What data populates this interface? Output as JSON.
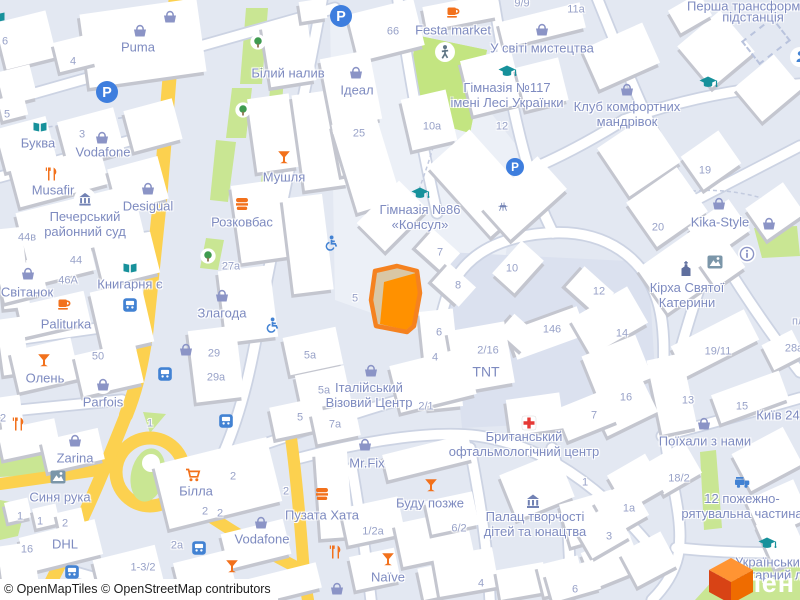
{
  "map": {
    "attribution": "© OpenMapTiles © OpenStreetMap contributors",
    "watermark_text": "лен",
    "colors": {
      "background": "#e3e8f2",
      "building": "#ffffff",
      "building_shadow": "#c4c6cf",
      "road_white": "#ffffff",
      "road_casing": "#ccd3e3",
      "road_yellow": "#fcd14f",
      "green": "#c9e693",
      "park_green": "#c3e581",
      "label_blue": "#7e8bc0",
      "number_blue": "#98a2c8",
      "poi_orange": "#f2711c",
      "poi_teal": "#17919b",
      "transit_blue": "#4282d3",
      "parking_blue": "#3e7ede",
      "selection_orange": "#ff9100",
      "red_cross": "#e53935",
      "civic_blue": "#7282b4"
    },
    "labels": [
      {
        "t": "Puma",
        "x": 138,
        "y": 47
      },
      {
        "t": "Білий налив",
        "x": 288,
        "y": 73
      },
      {
        "t": "Буква",
        "x": 38,
        "y": 143
      },
      {
        "t": "Vodafone",
        "x": 103,
        "y": 152
      },
      {
        "t": "Musafir",
        "x": 53,
        "y": 190
      },
      {
        "t": "Desigual",
        "x": 148,
        "y": 206
      },
      {
        "lines": [
          "Печерський",
          "районний суд"
        ],
        "x": 85,
        "y": 224
      },
      {
        "t": "Світанок",
        "x": 27,
        "y": 292
      },
      {
        "t": "Книгарня є",
        "x": 130,
        "y": 284
      },
      {
        "t": "Paliturka",
        "x": 66,
        "y": 324
      },
      {
        "t": "Олень",
        "x": 45,
        "y": 378
      },
      {
        "t": "Parfois",
        "x": 103,
        "y": 402
      },
      {
        "t": "Zarina",
        "x": 75,
        "y": 458
      },
      {
        "t": "Синя рука",
        "x": 60,
        "y": 497
      },
      {
        "t": "DHL",
        "x": 65,
        "y": 544
      },
      {
        "t": "Білла",
        "x": 196,
        "y": 491
      },
      {
        "t": "Vodafone",
        "x": 262,
        "y": 539
      },
      {
        "t": "Bro Market",
        "x": 235,
        "y": 587
      },
      {
        "t": "Пузата Хата",
        "x": 322,
        "y": 515
      },
      {
        "t": "Mr.Fix",
        "x": 367,
        "y": 463
      },
      {
        "t": "Naïve",
        "x": 388,
        "y": 577
      },
      {
        "t": "Буду позже",
        "x": 430,
        "y": 503
      },
      {
        "lines": [
          "Британський",
          "офтальмологічний центр"
        ],
        "x": 524,
        "y": 444
      },
      {
        "lines": [
          "Палац творчості",
          "дітей та юнацтва"
        ],
        "x": 535,
        "y": 524
      },
      {
        "lines": [
          "12 пожежно-",
          "рятувальна частина"
        ],
        "x": 742,
        "y": 506
      },
      {
        "t": "Поїхали з нами",
        "x": 705,
        "y": 441
      },
      {
        "t": "Український",
        "x": 735,
        "y": 562,
        "a": "l"
      },
      {
        "t": "гуманітарний ліцей",
        "x": 712,
        "y": 575,
        "a": "l"
      },
      {
        "lines": [
          "Кірха Святої",
          "Катерини"
        ],
        "x": 687,
        "y": 295
      },
      {
        "t": "Kika-Style",
        "x": 720,
        "y": 222
      },
      {
        "lines": [
          "Клуб комфортних",
          "мандрівок"
        ],
        "x": 627,
        "y": 114
      },
      {
        "t": "Перша трансформаторна",
        "x": 687,
        "y": 6,
        "a": "l"
      },
      {
        "t": "підстанція",
        "x": 753,
        "y": 17
      },
      {
        "t": "У світі мистецтва",
        "x": 542,
        "y": 48
      },
      {
        "lines": [
          "Гімназія №117",
          "імені Лесі Українки"
        ],
        "x": 507,
        "y": 95
      },
      {
        "lines": [
          "Гімназія №86",
          "«Консул»"
        ],
        "x": 420,
        "y": 217
      },
      {
        "t": "Ідеал",
        "x": 357,
        "y": 90
      },
      {
        "t": "Festa market",
        "x": 453,
        "y": 30
      },
      {
        "t": "Мушля",
        "x": 284,
        "y": 177
      },
      {
        "t": "Розковбас",
        "x": 242,
        "y": 222
      },
      {
        "t": "Злагода",
        "x": 222,
        "y": 313
      },
      {
        "lines": [
          "Італійський",
          "Візовий Центр"
        ],
        "x": 369,
        "y": 395
      },
      {
        "t": "TNT",
        "x": 486,
        "y": 372,
        "s": 14
      },
      {
        "t": "Київ 24",
        "x": 778,
        "y": 415
      },
      {
        "t": "6",
        "x": 5,
        "y": 42,
        "c": "n"
      },
      {
        "t": "4",
        "x": 73,
        "y": 62,
        "c": "n"
      },
      {
        "t": "5",
        "x": 7,
        "y": 115,
        "c": "n"
      },
      {
        "t": "3",
        "x": 82,
        "y": 135,
        "c": "n"
      },
      {
        "t": "44в",
        "x": 27,
        "y": 238,
        "c": "n"
      },
      {
        "t": "44",
        "x": 76,
        "y": 261,
        "c": "n"
      },
      {
        "t": "46А",
        "x": 68,
        "y": 281,
        "c": "n"
      },
      {
        "t": "50",
        "x": 98,
        "y": 357,
        "c": "n"
      },
      {
        "t": "2",
        "x": 3,
        "y": 419,
        "c": "n"
      },
      {
        "t": "1",
        "x": 20,
        "y": 517,
        "c": "n"
      },
      {
        "t": "1",
        "x": 40,
        "y": 522,
        "c": "n"
      },
      {
        "t": "2",
        "x": 65,
        "y": 524,
        "c": "n"
      },
      {
        "t": "16",
        "x": 27,
        "y": 550,
        "c": "n"
      },
      {
        "t": "1",
        "x": 150,
        "y": 424,
        "c": "n"
      },
      {
        "t": "2",
        "x": 233,
        "y": 477,
        "c": "n"
      },
      {
        "t": "2",
        "x": 205,
        "y": 512,
        "c": "n"
      },
      {
        "t": "2",
        "x": 220,
        "y": 514,
        "c": "n"
      },
      {
        "t": "2",
        "x": 286,
        "y": 492,
        "c": "n"
      },
      {
        "t": "2a",
        "x": 177,
        "y": 546,
        "c": "n"
      },
      {
        "t": "1-3/2",
        "x": 143,
        "y": 568,
        "c": "n"
      },
      {
        "t": "27а",
        "x": 231,
        "y": 267,
        "c": "n"
      },
      {
        "t": "29",
        "x": 214,
        "y": 354,
        "c": "n"
      },
      {
        "t": "29а",
        "x": 216,
        "y": 378,
        "c": "n"
      },
      {
        "t": "25",
        "x": 359,
        "y": 134,
        "c": "n"
      },
      {
        "t": "66",
        "x": 393,
        "y": 32,
        "c": "n"
      },
      {
        "t": "10a",
        "x": 432,
        "y": 127,
        "c": "n"
      },
      {
        "t": "12",
        "x": 502,
        "y": 127,
        "c": "n"
      },
      {
        "t": "9/9",
        "x": 522,
        "y": 4,
        "c": "n"
      },
      {
        "t": "11a",
        "x": 576,
        "y": 10,
        "c": "n"
      },
      {
        "t": "5а",
        "x": 310,
        "y": 356,
        "c": "n"
      },
      {
        "t": "5а",
        "x": 324,
        "y": 391,
        "c": "n"
      },
      {
        "t": "5",
        "x": 300,
        "y": 418,
        "c": "n"
      },
      {
        "t": "7а",
        "x": 335,
        "y": 425,
        "c": "n"
      },
      {
        "t": "5",
        "x": 355,
        "y": 299,
        "c": "n"
      },
      {
        "t": "7",
        "x": 440,
        "y": 253,
        "c": "n"
      },
      {
        "t": "8",
        "x": 458,
        "y": 286,
        "c": "n"
      },
      {
        "t": "10",
        "x": 512,
        "y": 269,
        "c": "n"
      },
      {
        "t": "12",
        "x": 599,
        "y": 292,
        "c": "n"
      },
      {
        "t": "146",
        "x": 552,
        "y": 330,
        "c": "n"
      },
      {
        "t": "6",
        "x": 439,
        "y": 333,
        "c": "n"
      },
      {
        "t": "4",
        "x": 435,
        "y": 358,
        "c": "n"
      },
      {
        "t": "2/16",
        "x": 488,
        "y": 351,
        "c": "n"
      },
      {
        "t": "2/1",
        "x": 426,
        "y": 407,
        "c": "n"
      },
      {
        "t": "14",
        "x": 622,
        "y": 334,
        "c": "n"
      },
      {
        "t": "16",
        "x": 626,
        "y": 398,
        "c": "n"
      },
      {
        "t": "7",
        "x": 594,
        "y": 416,
        "c": "n"
      },
      {
        "t": "6/2",
        "x": 459,
        "y": 529,
        "c": "n"
      },
      {
        "t": "1/2a",
        "x": 373,
        "y": 532,
        "c": "n"
      },
      {
        "t": "4",
        "x": 481,
        "y": 584,
        "c": "n"
      },
      {
        "t": "19",
        "x": 705,
        "y": 171,
        "c": "n"
      },
      {
        "t": "20",
        "x": 658,
        "y": 228,
        "c": "n"
      },
      {
        "t": "19/11",
        "x": 718,
        "y": 352,
        "c": "n"
      },
      {
        "t": "28а",
        "x": 794,
        "y": 349,
        "c": "n"
      },
      {
        "t": "13",
        "x": 688,
        "y": 401,
        "c": "n"
      },
      {
        "t": "15",
        "x": 742,
        "y": 407,
        "c": "n"
      },
      {
        "t": "18/2",
        "x": 679,
        "y": 479,
        "c": "n"
      },
      {
        "t": "1",
        "x": 585,
        "y": 483,
        "c": "n"
      },
      {
        "t": "1a",
        "x": 629,
        "y": 509,
        "c": "n"
      },
      {
        "t": "3",
        "x": 609,
        "y": 537,
        "c": "n"
      },
      {
        "t": "6",
        "x": 575,
        "y": 590,
        "c": "n"
      },
      {
        "t": "пл",
        "x": 792,
        "y": 322,
        "c": "n",
        "a": "l"
      }
    ],
    "icons": [
      {
        "t": "parking",
        "x": 107,
        "y": 92,
        "r": 11
      },
      {
        "t": "parking",
        "x": 341,
        "y": 16,
        "r": 11
      },
      {
        "t": "parking",
        "x": 515,
        "y": 167,
        "r": 9
      },
      {
        "t": "basket",
        "x": 140,
        "y": 31
      },
      {
        "t": "basket-circle",
        "x": 170,
        "y": 17
      },
      {
        "t": "book",
        "x": 40,
        "y": 127
      },
      {
        "t": "book",
        "x": -2,
        "y": 17
      },
      {
        "t": "basket",
        "x": 102,
        "y": 138
      },
      {
        "t": "restaurant",
        "x": 52,
        "y": 174
      },
      {
        "t": "basket-circle",
        "x": 148,
        "y": 189
      },
      {
        "t": "bank-circle",
        "x": 85,
        "y": 199
      },
      {
        "t": "book",
        "x": 130,
        "y": 268
      },
      {
        "t": "basket",
        "x": 28,
        "y": 274
      },
      {
        "t": "cup",
        "x": 64,
        "y": 303
      },
      {
        "t": "bus",
        "x": 130,
        "y": 305
      },
      {
        "t": "cocktail",
        "x": 44,
        "y": 360
      },
      {
        "t": "basket-circle",
        "x": 103,
        "y": 385
      },
      {
        "t": "basket",
        "x": 186,
        "y": 350
      },
      {
        "t": "bus",
        "x": 165,
        "y": 374
      },
      {
        "t": "restaurant",
        "x": 19,
        "y": 424
      },
      {
        "t": "basket",
        "x": 75,
        "y": 441
      },
      {
        "t": "artwork",
        "x": 58,
        "y": 477
      },
      {
        "t": "cart",
        "x": 193,
        "y": 475
      },
      {
        "t": "bus",
        "x": 226,
        "y": 421
      },
      {
        "t": "basket",
        "x": 261,
        "y": 523
      },
      {
        "t": "bus",
        "x": 199,
        "y": 548
      },
      {
        "t": "cocktail",
        "x": 232,
        "y": 566
      },
      {
        "t": "bus",
        "x": 72,
        "y": 572
      },
      {
        "t": "fastfood",
        "x": 322,
        "y": 494
      },
      {
        "t": "basket",
        "x": 365,
        "y": 445
      },
      {
        "t": "restaurant",
        "x": 336,
        "y": 552
      },
      {
        "t": "cocktail",
        "x": 388,
        "y": 559
      },
      {
        "t": "basket",
        "x": 337,
        "y": 589
      },
      {
        "t": "cocktail",
        "x": 431,
        "y": 485
      },
      {
        "t": "cross",
        "x": 529,
        "y": 423
      },
      {
        "t": "museum",
        "x": 533,
        "y": 501
      },
      {
        "t": "fire",
        "x": 742,
        "y": 481
      },
      {
        "t": "gradcap",
        "x": 767,
        "y": 543
      },
      {
        "t": "basket",
        "x": 704,
        "y": 424
      },
      {
        "t": "basket",
        "x": 627,
        "y": 90
      },
      {
        "t": "gradcap",
        "x": 708,
        "y": 82
      },
      {
        "t": "gradcap",
        "x": 507,
        "y": 71
      },
      {
        "t": "gradcap",
        "x": 420,
        "y": 193
      },
      {
        "t": "cup",
        "x": 453,
        "y": 11
      },
      {
        "t": "basket",
        "x": 542,
        "y": 30
      },
      {
        "t": "walk",
        "x": 445,
        "y": 52
      },
      {
        "t": "cocktail",
        "x": 284,
        "y": 157
      },
      {
        "t": "fastfood",
        "x": 242,
        "y": 204
      },
      {
        "t": "tree",
        "x": 258,
        "y": 42,
        "i": 0
      },
      {
        "t": "tree",
        "x": 243,
        "y": 110,
        "i": 0
      },
      {
        "t": "tree",
        "x": 208,
        "y": 256,
        "i": 0
      },
      {
        "t": "basket",
        "x": 222,
        "y": 296
      },
      {
        "t": "wheelchair",
        "x": 272,
        "y": 325
      },
      {
        "t": "wheelchair",
        "x": 331,
        "y": 243
      },
      {
        "t": "basket",
        "x": 371,
        "y": 371
      },
      {
        "t": "basket",
        "x": 719,
        "y": 204
      },
      {
        "t": "basket",
        "x": 769,
        "y": 224
      },
      {
        "t": "info",
        "x": 747,
        "y": 254
      },
      {
        "t": "artwork",
        "x": 715,
        "y": 262
      },
      {
        "t": "church",
        "x": 686,
        "y": 270
      },
      {
        "t": "basket",
        "x": 356,
        "y": 73
      },
      {
        "t": "grill",
        "x": 503,
        "y": 207,
        "i": 0
      },
      {
        "t": "person-circle",
        "x": 800,
        "y": 57
      }
    ]
  }
}
